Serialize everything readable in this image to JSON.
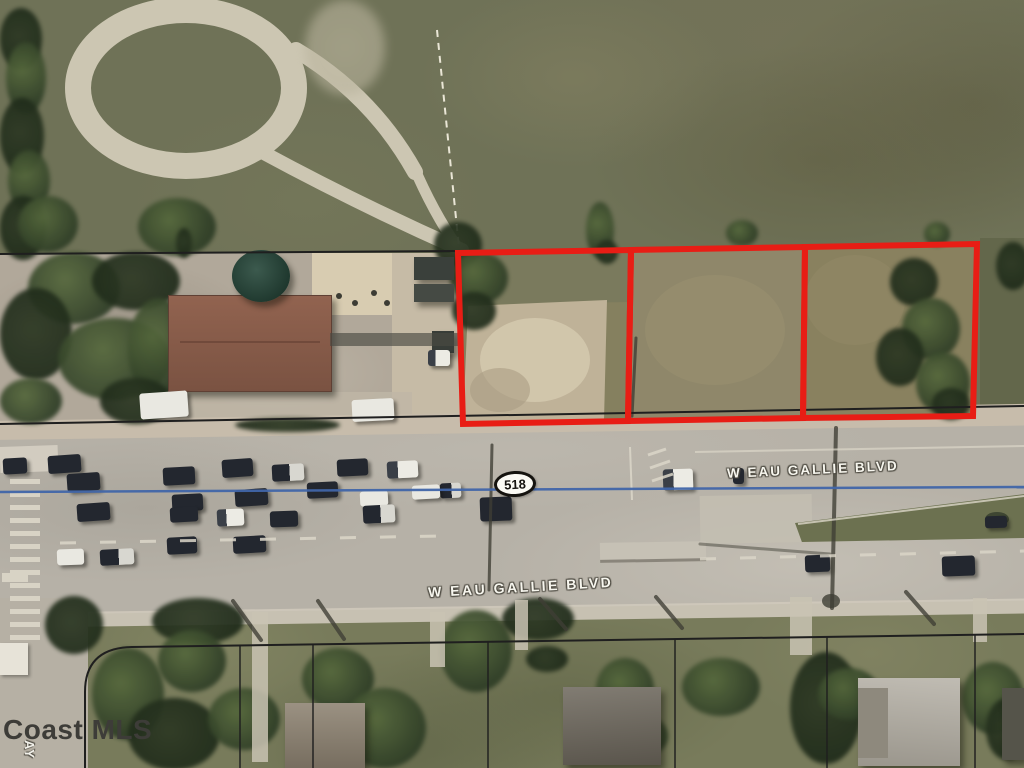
{
  "map": {
    "watermark": "Coast MLS",
    "route_shield": {
      "number": "518"
    },
    "road_labels": {
      "primary": "W EAU GALLIE BLVD",
      "secondary": "W EAU GALLIE BLVD"
    },
    "side_street_label": "AY",
    "annotations": {
      "highlighted_parcels": 3,
      "parcel_outline_color": "#e81d15",
      "boundary_line_color": "#1f1f1f",
      "route_line_color": "#4166a9"
    }
  }
}
